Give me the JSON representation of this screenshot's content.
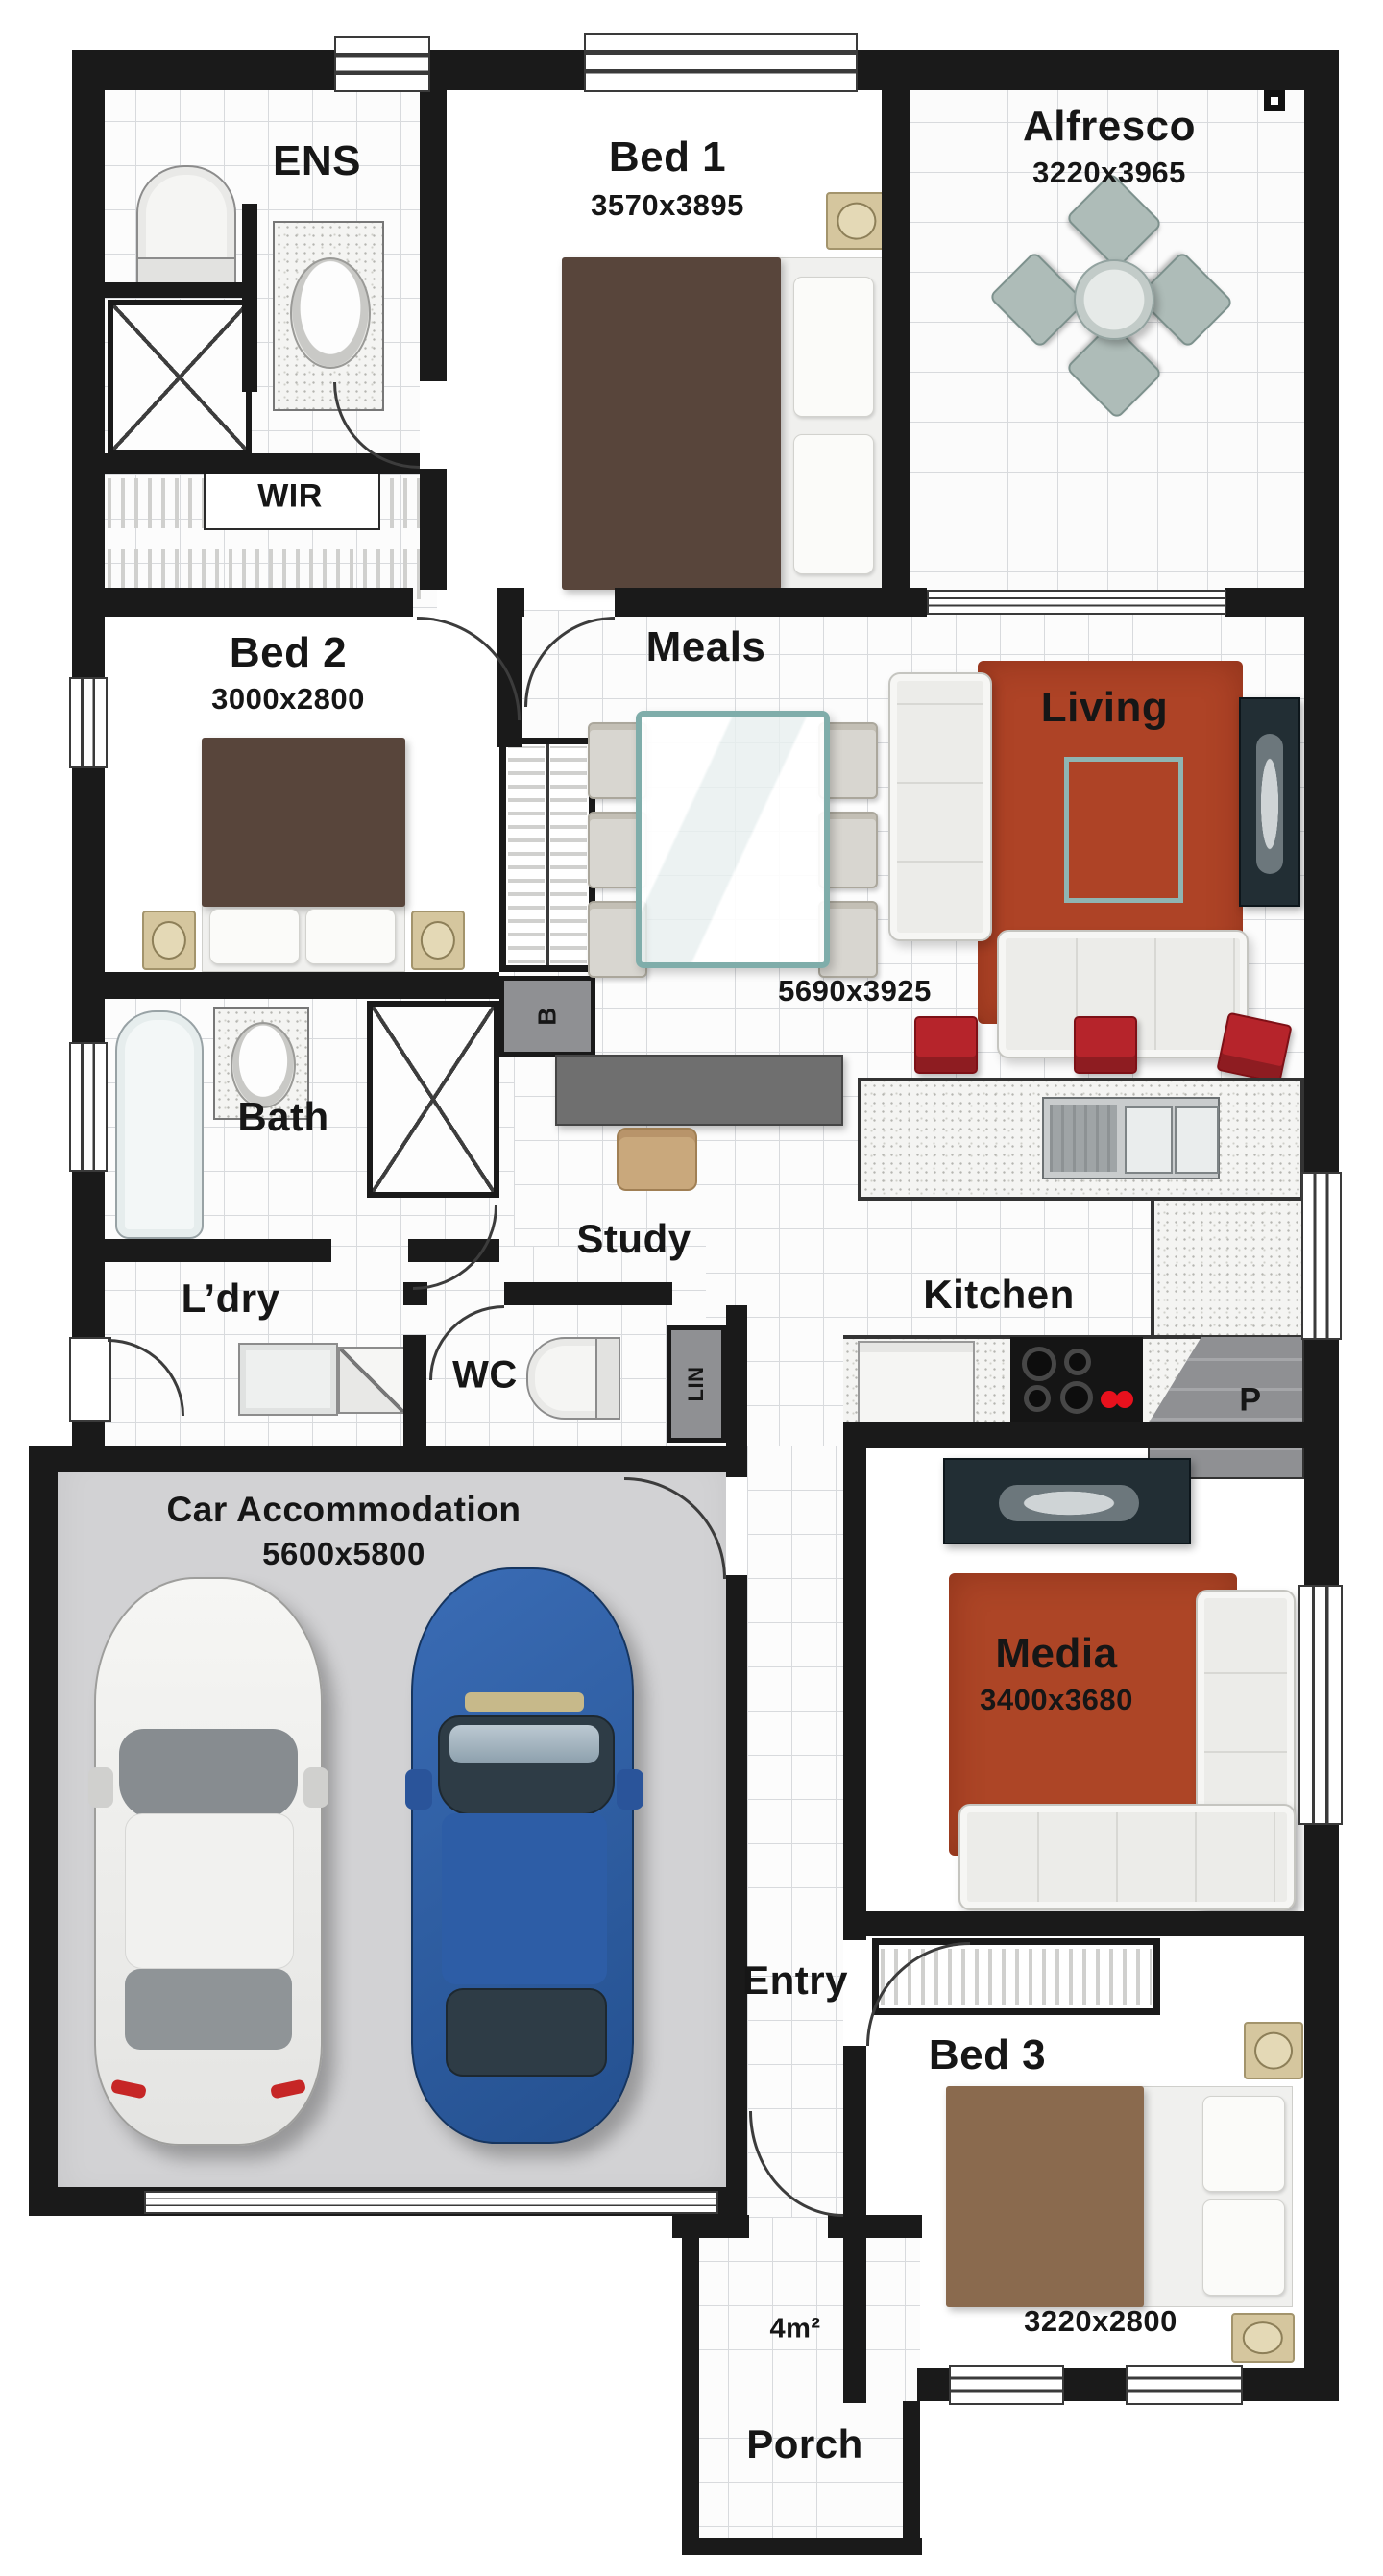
{
  "type": "floor-plan",
  "rooms": {
    "ens": {
      "label": "ENS"
    },
    "bed1": {
      "label": "Bed 1",
      "dims": "3570x3895"
    },
    "alfresco": {
      "label": "Alfresco",
      "dims": "3220x3965"
    },
    "wir": {
      "label": "WIR"
    },
    "bed2": {
      "label": "Bed 2",
      "dims": "3000x2800"
    },
    "meals": {
      "label": "Meals"
    },
    "living": {
      "label": "Living",
      "dims": "5690x3925"
    },
    "bath": {
      "label": "Bath"
    },
    "broom": {
      "label": "B"
    },
    "study": {
      "label": "Study"
    },
    "laundry": {
      "label": "L’dry"
    },
    "wc": {
      "label": "WC"
    },
    "linen": {
      "label": "LIN"
    },
    "kitchen": {
      "label": "Kitchen"
    },
    "pantry": {
      "label": "P"
    },
    "garage": {
      "label": "Car Accommodation",
      "dims": "5600x5800"
    },
    "media": {
      "label": "Media",
      "dims": "3400x3680"
    },
    "entry": {
      "label": "Entry"
    },
    "bed3": {
      "label": "Bed 3",
      "dims": "3220x2800"
    },
    "porch": {
      "label": "Porch",
      "area": "4m²"
    }
  },
  "colors": {
    "wall": "#1a1a1a",
    "rug_red": "#ae4326",
    "stool_red": "#b6242b",
    "car_blue": "#2e62ab",
    "car_white": "#f3f3f1",
    "garage_floor": "#d2d2d4",
    "bed_brown_dark": "#58453b",
    "bed_brown_light": "#8a6a4e",
    "glass_teal": "#7fadaa"
  }
}
